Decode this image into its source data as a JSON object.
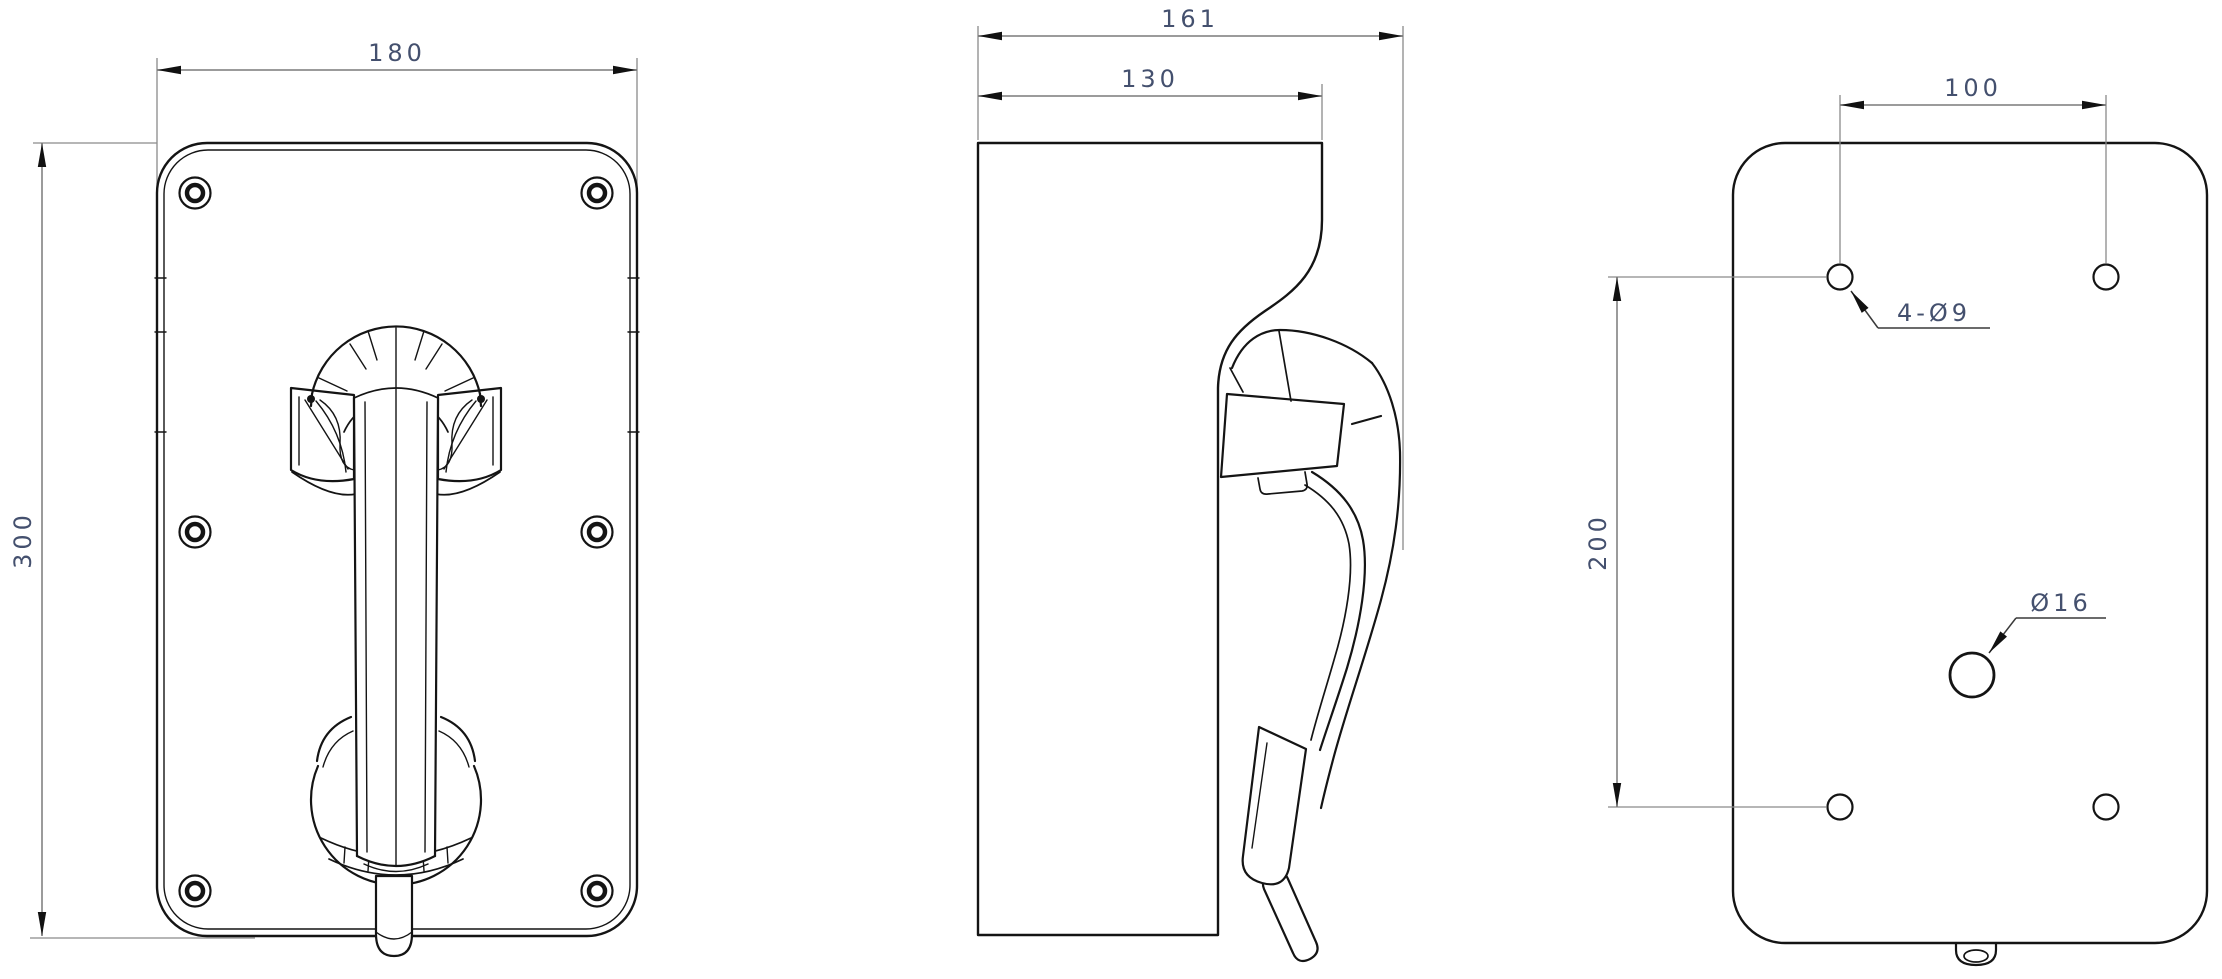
{
  "sheet": {
    "background": "#ffffff",
    "line_color": "#141414",
    "dim_line_color": "#7a7a7a",
    "dim_text_color": "#44506e"
  },
  "front_view": {
    "width_dim": "180",
    "height_dim": "300"
  },
  "side_view": {
    "overall_depth_dim": "161",
    "body_depth_dim": "130"
  },
  "back_view": {
    "hole_spacing_h_dim": "100",
    "hole_spacing_v_dim": "200",
    "mounting_holes_label": "4-Ø9",
    "cable_hole_label": "Ø16"
  }
}
